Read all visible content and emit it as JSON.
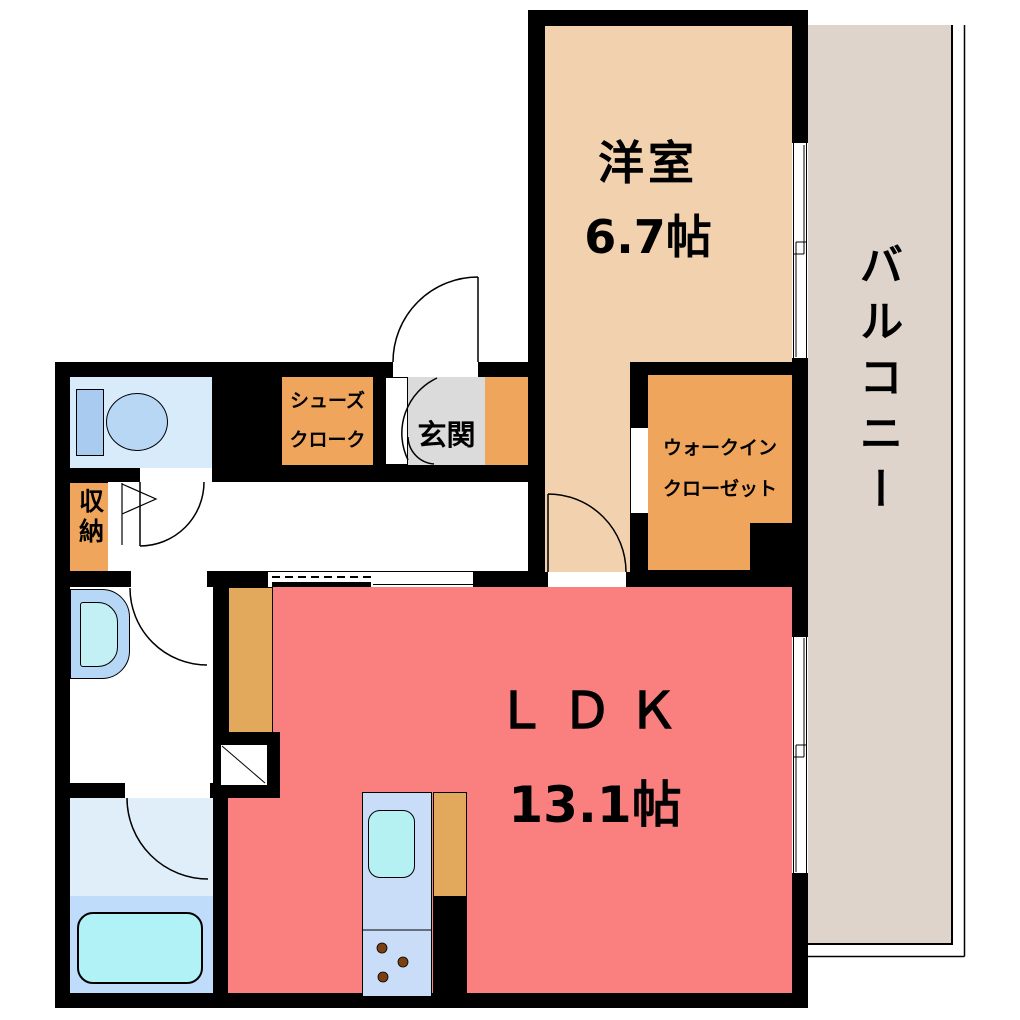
{
  "rooms": {
    "western_room": {
      "label": "洋室",
      "size": "6.7帖"
    },
    "balcony": {
      "label": "バルコニー"
    },
    "ldk": {
      "label": "ＬＤＫ",
      "size": "13.1帖"
    },
    "entrance": {
      "label": "玄関"
    },
    "shoes_cloak": {
      "line1": "シューズ",
      "line2": "クローク"
    },
    "walk_in_closet": {
      "line1": "ウォークイン",
      "line2": "クローゼット"
    },
    "storage": {
      "label": "収納"
    }
  },
  "colors": {
    "wall": "#000000",
    "western_room": "#F2D1AE",
    "balcony": "#DED4CC",
    "ldk": "#FA8080",
    "entrance_floor": "#DBDBDB",
    "storage_orange": "#EFA55C",
    "counter_tan": "#E2A95C",
    "toilet_room": "#D8EBFA",
    "toilet_fixture": "#B7D7F5",
    "washbasin": "#C2F0F5",
    "bathroom_upper": "#E0EEFA",
    "bathroom_lower": "#BFDCFA",
    "bathtub": "#B0F2F5",
    "kitchen_counter": "#C9DCF8",
    "kitchen_sink": "#B5F0F2",
    "burner": "#7B3F10"
  }
}
